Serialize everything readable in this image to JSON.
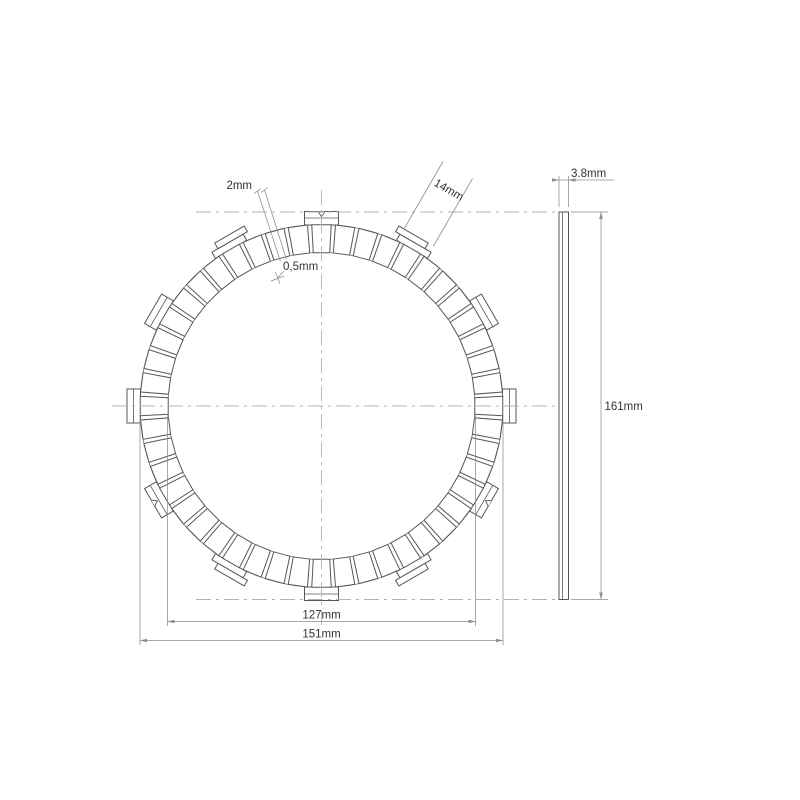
{
  "labels": {
    "pad_gap": "2mm",
    "chamfer": "0,5mm",
    "tab_width": "14mm",
    "inner_diameter": "127mm",
    "friction_diameter": "151mm",
    "thickness": "3.8mm",
    "overall_diameter": "161mm"
  },
  "geometry": {
    "front": {
      "cx": 321.5,
      "cy": 406,
      "r_outer": 181.5,
      "r_inner": 153.5,
      "r_tab": 194.5,
      "pad_count": 48,
      "pad_width_deg": 6.15,
      "tab_count": 12,
      "tab_half_width": 17,
      "collar_r": 188,
      "cap_split_r": 188,
      "offset_tabs": {
        "30": -6,
        "150": 6,
        "210": -6,
        "330": 6
      },
      "notch_tabs": [
        0,
        120,
        240
      ]
    },
    "side": {
      "x": 559,
      "w": 9.5,
      "y_top": 212,
      "y_bot": 599.5,
      "core_x": 562.5
    }
  },
  "colors": {
    "line": "#575757",
    "circle": "#6e6e6e",
    "dim": "#8c8c8c",
    "center": "#b3b3b3",
    "text": "#333333"
  }
}
